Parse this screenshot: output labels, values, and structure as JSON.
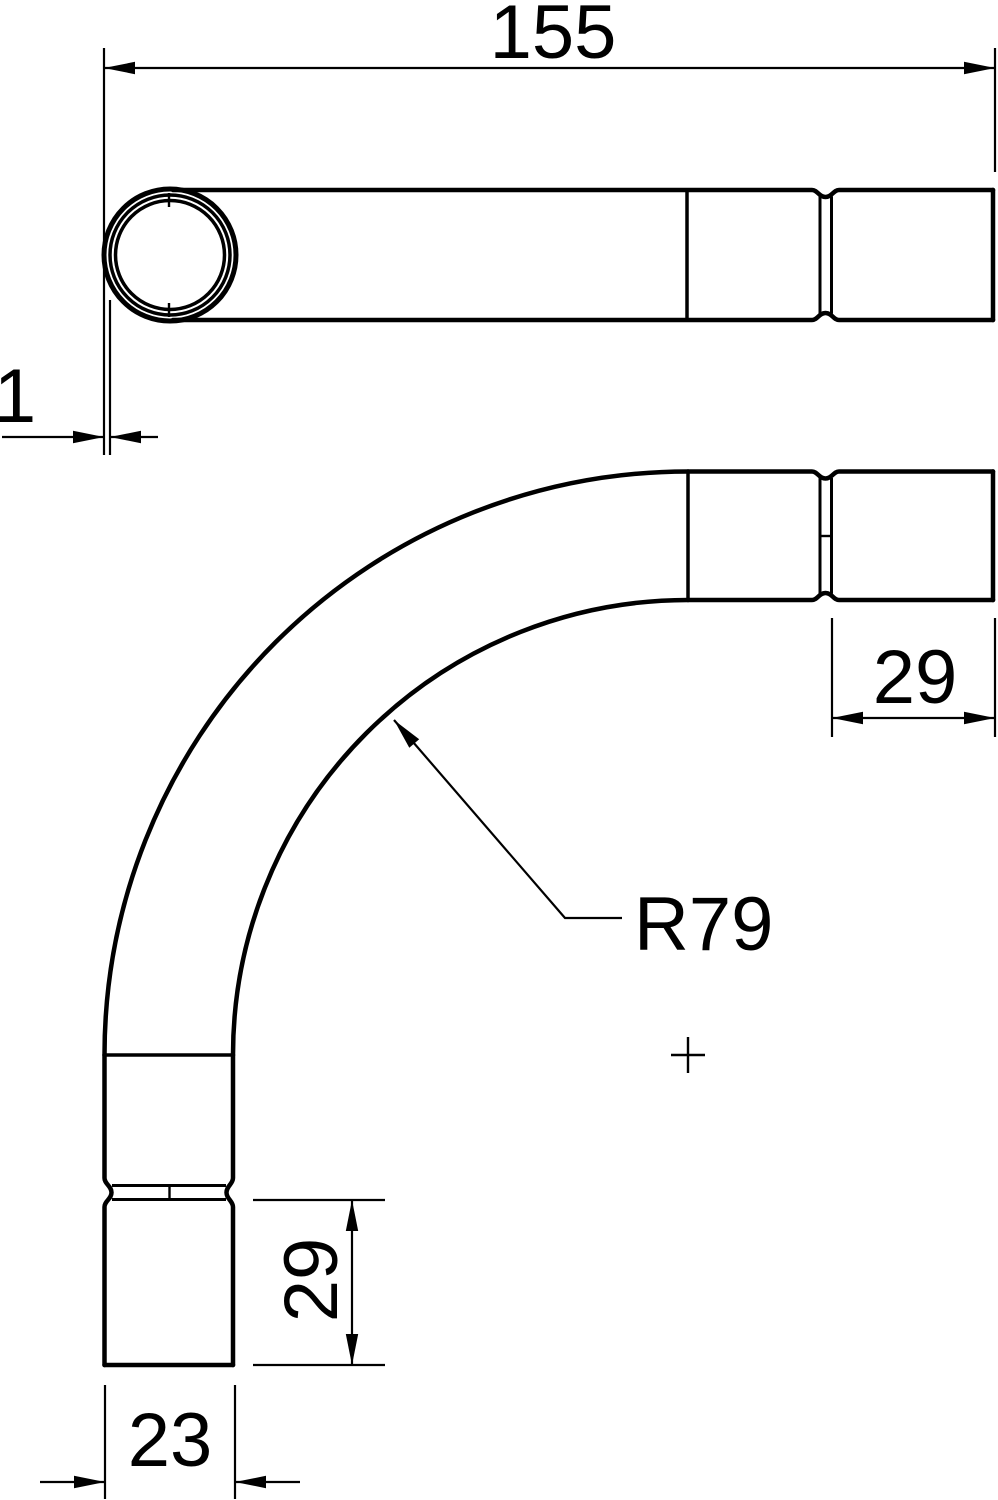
{
  "colors": {
    "background": "#ffffff",
    "ink": "#000000"
  },
  "side_view": {
    "dim_overall_length": "155",
    "dim_wall_thickness": "1"
  },
  "bend_view": {
    "dim_socket_length_right": "29",
    "dim_bend_radius": "R79",
    "dim_socket_length_bottom": "29",
    "dim_end_width": "23"
  }
}
